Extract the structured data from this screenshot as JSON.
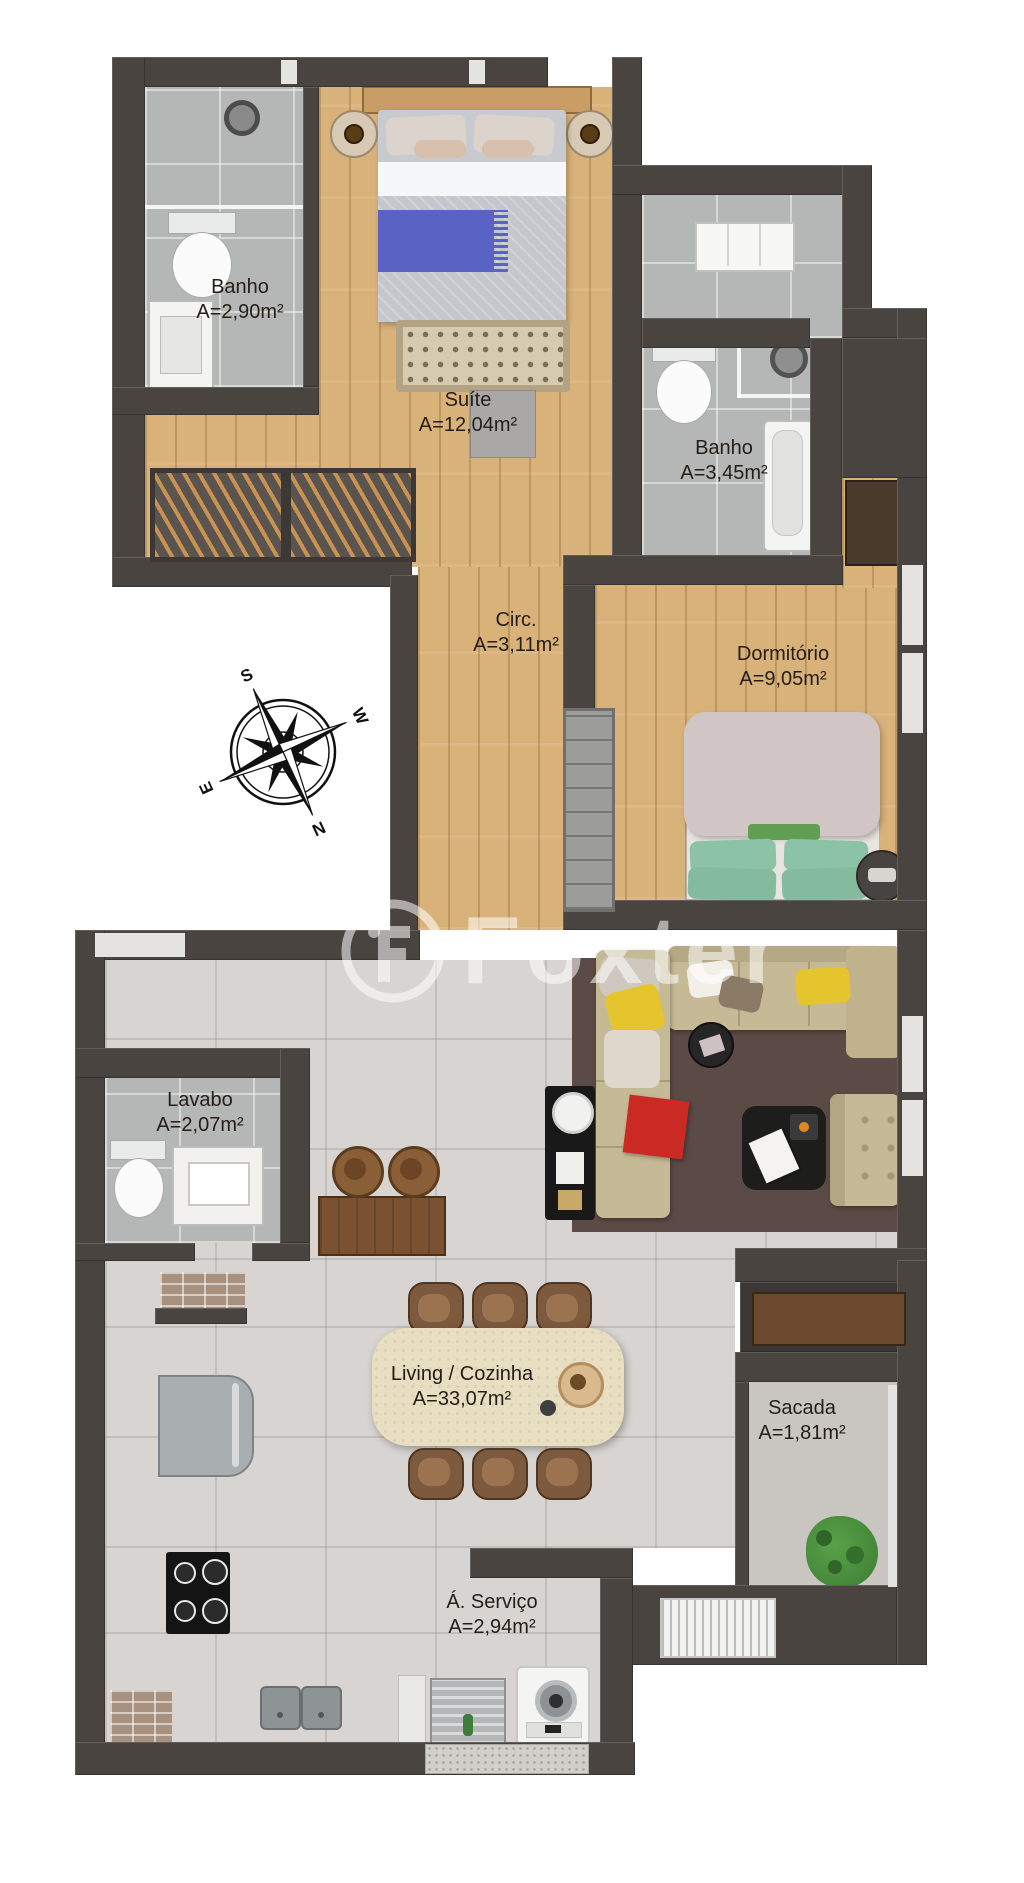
{
  "watermark": {
    "brand": "Foxter",
    "logo": "foxter-circle-monogram"
  },
  "compass": {
    "north": "N",
    "south": "S",
    "east": "E",
    "west": "W"
  },
  "rooms": [
    {
      "id": "banho-suite",
      "name": "Banho",
      "area": "A=2,90m²"
    },
    {
      "id": "suite",
      "name": "Suíte",
      "area": "A=12,04m²"
    },
    {
      "id": "banho-social",
      "name": "Banho",
      "area": "A=3,45m²"
    },
    {
      "id": "circulacao",
      "name": "Circ.",
      "area": "A=3,11m²"
    },
    {
      "id": "dormitorio",
      "name": "Dormitório",
      "area": "A=9,05m²"
    },
    {
      "id": "lavabo",
      "name": "Lavabo",
      "area": "A=2,07m²"
    },
    {
      "id": "living-cozinha",
      "name": "Living / Cozinha",
      "area": "A=33,07m²"
    },
    {
      "id": "sacada",
      "name": "Sacada",
      "area": "A=1,81m²"
    },
    {
      "id": "area-servico",
      "name": "Á. Serviço",
      "area": "A=2,94m²"
    }
  ],
  "colors": {
    "wall": "#494440",
    "wood_floor": "#d9b27a",
    "bath_tile": "#b5b7b6",
    "living_tile": "#d7d4d1",
    "balcony": "#c9c6c2",
    "rug": "#5c4a46",
    "sofa_beige": "#c6b995",
    "accent_yellow": "#e4c52e",
    "accent_red": "#cb2a24",
    "accent_blue": "#5a63c4",
    "pillow_green": "#8cc3a6",
    "plant_green": "#4d9440"
  }
}
